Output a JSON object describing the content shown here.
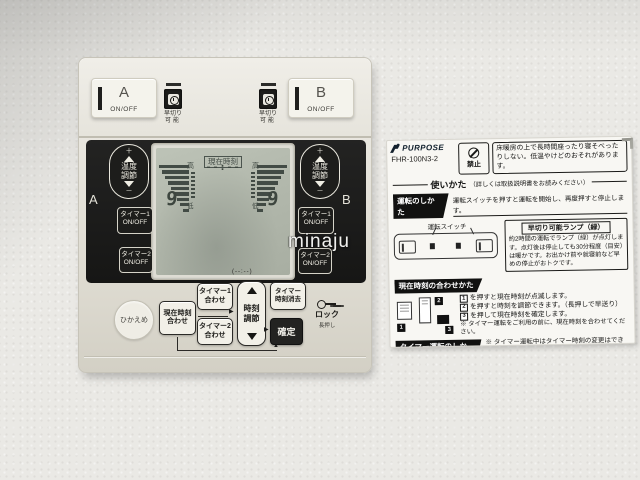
{
  "watermark": "minaju",
  "colors": {
    "panel_cream": "#e7e4da",
    "panel_dark": "#1b1b1a",
    "lcd_background": "#b2b8ac",
    "lcd_segment": "#3d463f",
    "sticker_paper": "#f8f7f3",
    "text_black": "#141413"
  },
  "icons": {
    "lamp_window": "clock-icon",
    "prohibition": "no-symbol-icon",
    "lock": "key-icon",
    "flow_arrows": "triangle-arrows"
  },
  "remote": {
    "top": {
      "a_label": "A",
      "a_onoff": "ON/OFF",
      "b_label": "B",
      "b_onoff": "ON/OFF",
      "lamp_caption_line1": "早切り",
      "lamp_caption_line2": "可能"
    },
    "lcd": {
      "current_time_label": "現在時刻",
      "time_value": "--:--",
      "high_left": "高",
      "high_right": "高",
      "low_left": "低",
      "low_right": "低",
      "level_left": "9",
      "level_right": "9"
    },
    "left_column": {
      "zone_label": "A",
      "temp_plus": "＋",
      "temp_label_1": "温度",
      "temp_label_2": "調節",
      "temp_minus": "－",
      "timer1_label": "タイマー1",
      "timer1_onoff": "ON/OFF",
      "timer2_label": "タイマー2",
      "timer2_onoff": "ON/OFF"
    },
    "right_column": {
      "zone_label": "B",
      "temp_plus": "＋",
      "temp_label_1": "温度",
      "temp_label_2": "調節",
      "temp_minus": "－",
      "timer1_label": "タイマー1",
      "timer1_onoff": "ON/OFF",
      "timer2_label": "タイマー2",
      "timer2_onoff": "ON/OFF"
    },
    "bottom": {
      "hikaeme": "ひかえめ",
      "current_time_set_1": "現在時刻",
      "current_time_set_2": "合わせ",
      "timer1_set_1": "タイマー1",
      "timer1_set_2": "合わせ",
      "timer2_set_1": "タイマー2",
      "timer2_set_2": "合わせ",
      "time_adjust_1": "時刻",
      "time_adjust_2": "調節",
      "timer_clear_1": "タイマー",
      "timer_clear_2": "時刻消去",
      "confirm": "確定",
      "lock": "ロック",
      "long_press": "長押し",
      "loop_hint": "(--:--)"
    }
  },
  "sticker": {
    "brand": "PURPOSE",
    "model": "FHR-100N3-2",
    "prohibition_label": "禁止",
    "warning_text": "床暖房の上で長時間座ったり寝そべったりしない。低温やけどのおそれがあります。",
    "usage_title": "使いかた",
    "usage_note": "（詳しくは取扱説明書をお読みください）",
    "operation": {
      "title": "運転のしかた",
      "headline": "運転スイッチを押すと運転を開始し、再度押すと停止します。",
      "switch_label": "運転スイッチ",
      "lamp_title": "早切り可能ランプ（緑）",
      "lamp_text": "約2時間の運転でランプ（緑）が点灯します。点灯後は停止しても30分程度（目安）は暖かです。お出かけ前や就寝前など早めの停止がおトクです。"
    },
    "time_setting": {
      "title": "現在時刻の合わせかた",
      "markers": [
        "1",
        "2",
        "3"
      ],
      "steps": [
        "を押すと現在時刻が点滅します。",
        "を押すと時刻を調節できます。（長押しで早送り）",
        "を押して現在時刻を確定します。"
      ],
      "note": "※ タイマー運転をご利用の前に、現在時刻を合わせてください。"
    },
    "timer": {
      "title": "タイマー運転のしかた",
      "note": "※ タイマー運転中はタイマー時刻の変更はできません。",
      "markers": [
        "1",
        "2",
        "3",
        "4"
      ],
      "steps": [
        "を押してタイマー1（2）の入時刻を合わせます。",
        "を押すと時刻を調節できます。（長押しで早送り）",
        "を押すと入時刻から切時刻に切替わります。",
        "を押すことでタイマー運転を開始・解除します。"
      ],
      "substep2": "【●を押すと--:--に設定できます】",
      "substep3": "（②と③の操作を繰り返します）",
      "lamp_note_pre": "※ タイマー運転中は",
      "lamp_note_post": "ランプ（橙）が点灯します。",
      "code": "84V013"
    }
  }
}
